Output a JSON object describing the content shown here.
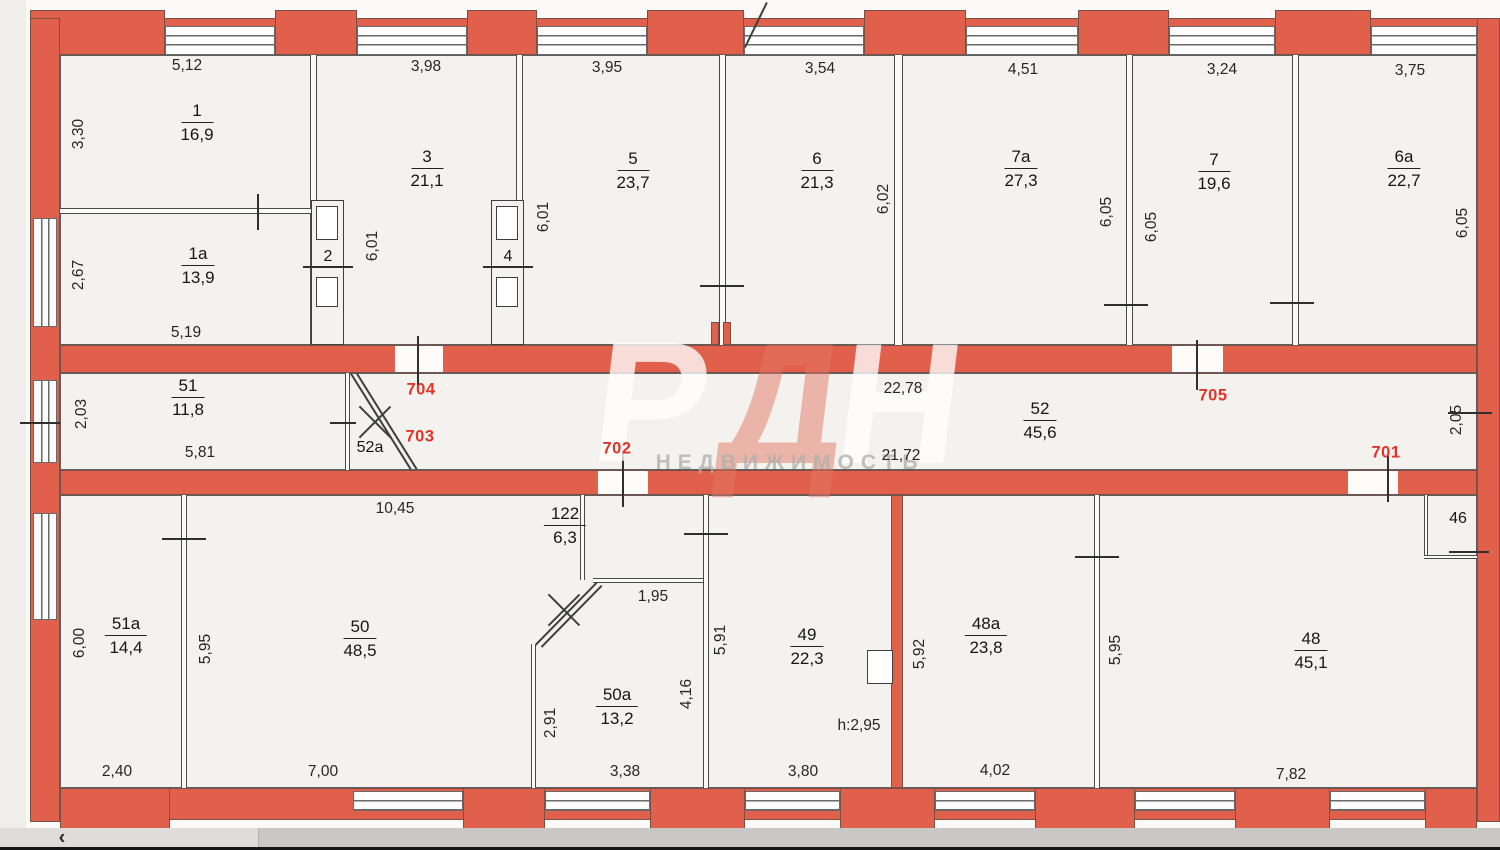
{
  "watermark": {
    "letters": [
      "Р",
      "Д",
      "Н"
    ],
    "subtitle": "НЕДВИЖИМОСТЬ"
  },
  "colors": {
    "wall": "#e0604c",
    "door_label": "#e33226"
  },
  "doors": {
    "701": "701",
    "702": "702",
    "703": "703",
    "704": "704",
    "705": "705"
  },
  "rooms": {
    "r1": {
      "num": "1",
      "area": "16,9",
      "w": "5,12",
      "h": "3,30"
    },
    "r1a": {
      "num": "1a",
      "area": "13,9",
      "h": "2,67",
      "wb": "5,19"
    },
    "sh2": {
      "num": "2"
    },
    "r3": {
      "num": "3",
      "area": "21,1",
      "w": "3,98",
      "h": "6,01"
    },
    "sh4": {
      "num": "4"
    },
    "r5": {
      "num": "5",
      "area": "23,7",
      "w": "3,95",
      "h": "6,01"
    },
    "r6": {
      "num": "6",
      "area": "21,3",
      "w": "3,54",
      "h": "6,02"
    },
    "r7a": {
      "num": "7a",
      "area": "27,3",
      "w": "4,51",
      "h": "6,05"
    },
    "r7": {
      "num": "7",
      "area": "19,6",
      "w": "3,24",
      "h": "6,05"
    },
    "r6a": {
      "num": "6a",
      "area": "22,7",
      "w": "3,75",
      "h": "6,05"
    },
    "r51": {
      "num": "51",
      "area": "11,8",
      "h": "2,03",
      "wb": "5,81"
    },
    "r52a": {
      "num": "52a"
    },
    "r52": {
      "num": "52",
      "area": "45,6",
      "wt": "22,78",
      "wb": "21,72",
      "h": "2,05"
    },
    "r51a": {
      "num": "51a",
      "area": "14,4",
      "h": "6,00",
      "wb": "2,40"
    },
    "r50": {
      "num": "50",
      "area": "48,5",
      "wt": "10,45",
      "wb": "7,00",
      "h": "5,95"
    },
    "r122": {
      "num": "122",
      "area": "6,3"
    },
    "r50a": {
      "num": "50a",
      "area": "13,2",
      "wt": "1,95",
      "hl": "2,91",
      "hr": "4,16",
      "wb": "3,38"
    },
    "r49": {
      "num": "49",
      "area": "22,3",
      "h": "5,91",
      "wb": "3,80",
      "note": "h:2,95"
    },
    "r48a": {
      "num": "48a",
      "area": "23,8",
      "h": "5,92",
      "wb": "4,02"
    },
    "r48": {
      "num": "48",
      "area": "45,1",
      "h": "5,95",
      "wb": "7,82"
    },
    "r46": {
      "num": "46"
    }
  },
  "scrollbar": {
    "back": "‹"
  }
}
